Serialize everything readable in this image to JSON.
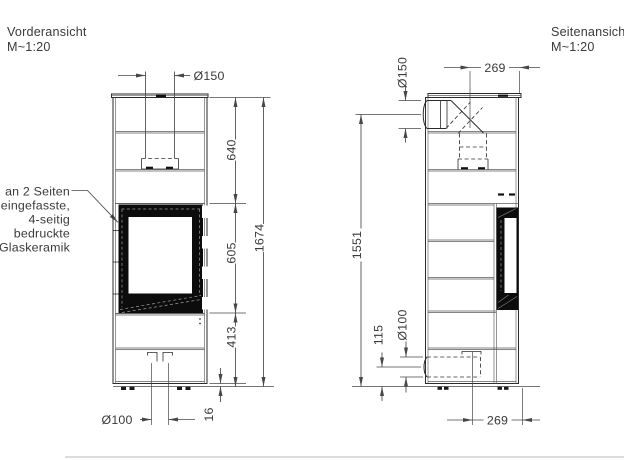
{
  "front_view": {
    "title": "Vorderansicht",
    "scale_label": "M~1:20",
    "glass_note_lines": [
      "an 2 Seiten",
      "eingefasste,",
      "4-seitig",
      "bedruckte",
      "Glaskeramik"
    ],
    "dims": {
      "flue_diameter": "Ø150",
      "upper_height": "640",
      "total_height": "1674",
      "glass_height": "605",
      "lower_height": "413",
      "air_diameter": "Ø100",
      "floor_clearance": "16"
    }
  },
  "side_view": {
    "title": "Seitenansicht",
    "scale_label": "M~1:20",
    "dims": {
      "flue_diameter": "Ø150",
      "flue_axis_depth": "269",
      "flue_axis_height": "1551",
      "air_axis_height": "115",
      "air_diameter": "Ø100",
      "air_axis_depth": "269"
    }
  },
  "colors": {
    "line": "#2b2b2b",
    "glass_frame": "#0c0c0c",
    "dimension": "#474747"
  }
}
